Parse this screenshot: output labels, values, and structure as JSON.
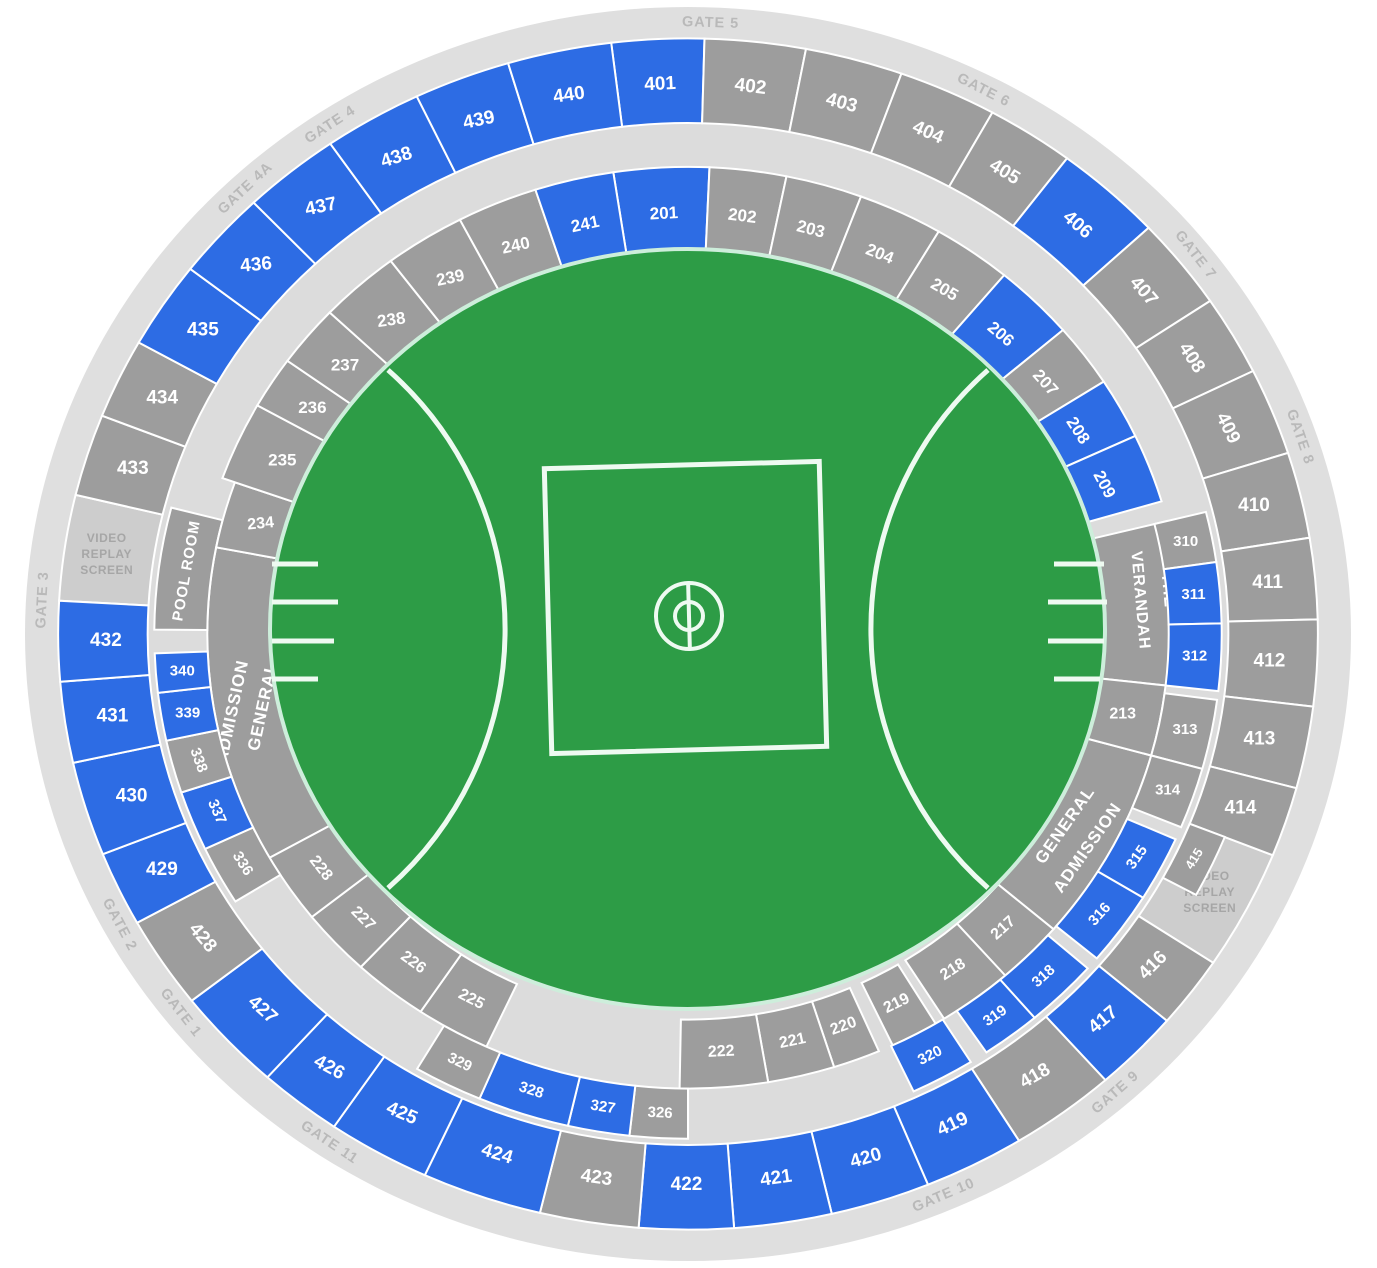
{
  "map": {
    "colors": {
      "available": "#2d6ce4",
      "standard": "#9d9d9d",
      "screen_fill": "#cdcdcd",
      "walkway": "#dcdcdc",
      "promenade": "#dfdfdf",
      "field": "#2d9c46",
      "field_edge": "#cdeedb",
      "field_line": "#eefaf1",
      "gate_text": "#b9b9b9",
      "screen_text": "#a6a6a6",
      "section_text": "#ffffff"
    },
    "gates": [
      {
        "label": "GATE 1",
        "a": 231.7,
        "rot": 52
      },
      {
        "label": "GATE 2",
        "a": 241.6,
        "rot": 62
      },
      {
        "label": "GATE 3",
        "a": 273.2,
        "rot": -87
      },
      {
        "label": "GATE 4A",
        "a": 316.8,
        "rot": -43
      },
      {
        "label": "GATE 4",
        "a": 326.4,
        "rot": -33
      },
      {
        "label": "GATE 5",
        "a": 2.0,
        "rot": 2
      },
      {
        "label": "GATE 6",
        "a": 27.2,
        "rot": 27
      },
      {
        "label": "GATE 7",
        "a": 51.7,
        "rot": 52
      },
      {
        "label": "GATE 8",
        "a": 71.2,
        "rot": 71
      },
      {
        "label": "GATE 9",
        "a": 138.6,
        "rot": -41
      },
      {
        "label": "GATE 10",
        "a": 156.7,
        "rot": -23
      },
      {
        "label": "GATE 11",
        "a": 213.7,
        "rot": 34
      }
    ],
    "outer_sections": [
      {
        "n": "401",
        "a0": 353.0,
        "a1": 361.5,
        "c": "b",
        "rot": -3
      },
      {
        "n": "402",
        "a0": 1.5,
        "a1": 10.8,
        "c": "g",
        "rot": 7
      },
      {
        "n": "403",
        "a0": 10.8,
        "a1": 19.8,
        "c": "g",
        "rot": 15
      },
      {
        "n": "404",
        "a0": 19.8,
        "a1": 28.9,
        "c": "g",
        "rot": 24
      },
      {
        "n": "405",
        "a0": 28.9,
        "a1": 37.0,
        "c": "g",
        "rot": 31
      },
      {
        "n": "406",
        "a0": 37.0,
        "a1": 47.0,
        "c": "b",
        "rot": 41
      },
      {
        "n": "407",
        "a0": 47.0,
        "a1": 56.0,
        "c": "g",
        "rot": 49
      },
      {
        "n": "408",
        "a0": 56.0,
        "a1": 63.8,
        "c": "g",
        "rot": 57
      },
      {
        "n": "409",
        "a0": 63.8,
        "a1": 72.3,
        "c": "g",
        "rot": 64
      },
      {
        "n": "410",
        "a0": 72.3,
        "a1": 80.7,
        "c": "g",
        "rot": 0
      },
      {
        "n": "411",
        "a0": 80.7,
        "a1": 88.6,
        "c": "g",
        "rot": 0
      },
      {
        "n": "412",
        "a0": 88.6,
        "a1": 97.0,
        "c": "g",
        "rot": 0
      },
      {
        "n": "413",
        "a0": 97.0,
        "a1": 105.0,
        "c": "g",
        "rot": 0
      },
      {
        "n": "414",
        "a0": 105.0,
        "a1": 111.8,
        "c": "g",
        "rot": 0
      },
      {
        "n": "415",
        "a0": 111.8,
        "a1": 118.5,
        "c": "g",
        "rot": -58,
        "r0": 0.815,
        "r1": 0.872,
        "lr": 0.843,
        "fs": 13
      },
      {
        "n": "416",
        "a0": 123.5,
        "a1": 130.5,
        "c": "g",
        "rot": -45
      },
      {
        "n": "417",
        "a0": 130.5,
        "a1": 138.5,
        "c": "b",
        "rot": -40
      },
      {
        "n": "418",
        "a0": 138.5,
        "a1": 148.3,
        "c": "g",
        "rot": -30
      },
      {
        "n": "419",
        "a0": 148.3,
        "a1": 157.6,
        "c": "b",
        "rot": -25
      },
      {
        "n": "420",
        "a0": 157.6,
        "a1": 166.8,
        "c": "b",
        "rot": -16
      },
      {
        "n": "421",
        "a0": 166.8,
        "a1": 175.8,
        "c": "b",
        "rot": -8
      },
      {
        "n": "422",
        "a0": 175.8,
        "a1": 184.5,
        "c": "b",
        "rot": 0
      },
      {
        "n": "423",
        "a0": 184.5,
        "a1": 193.6,
        "c": "g",
        "rot": 8
      },
      {
        "n": "424",
        "a0": 193.6,
        "a1": 204.7,
        "c": "b",
        "rot": 17
      },
      {
        "n": "425",
        "a0": 204.7,
        "a1": 214.2,
        "c": "b",
        "rot": 23
      },
      {
        "n": "426",
        "a0": 214.2,
        "a1": 221.9,
        "c": "b",
        "rot": 28
      },
      {
        "n": "427",
        "a0": 221.9,
        "a1": 232.0,
        "c": "b",
        "rot": 42
      },
      {
        "n": "428",
        "a0": 232.0,
        "a1": 241.0,
        "c": "g",
        "rot": 50
      },
      {
        "n": "429",
        "a0": 241.0,
        "a1": 248.3,
        "c": "b",
        "rot": 0
      },
      {
        "n": "430",
        "a0": 248.3,
        "a1": 257.5,
        "c": "b",
        "rot": 0
      },
      {
        "n": "431",
        "a0": 257.5,
        "a1": 265.4,
        "c": "b",
        "rot": 0
      },
      {
        "n": "432",
        "a0": 265.4,
        "a1": 273.2,
        "c": "b",
        "rot": 0
      },
      {
        "n": "433",
        "a0": 283.5,
        "a1": 291.5,
        "c": "g",
        "rot": 0
      },
      {
        "n": "434",
        "a0": 291.5,
        "a1": 299.3,
        "c": "g",
        "rot": 0
      },
      {
        "n": "435",
        "a0": 299.3,
        "a1": 307.8,
        "c": "b",
        "rot": 0
      },
      {
        "n": "436",
        "a0": 307.8,
        "a1": 316.4,
        "c": "b",
        "rot": -5
      },
      {
        "n": "437",
        "a0": 316.4,
        "a1": 325.4,
        "c": "b",
        "rot": -12
      },
      {
        "n": "438",
        "a0": 325.4,
        "a1": 334.5,
        "c": "b",
        "rot": -18
      },
      {
        "n": "439",
        "a0": 334.5,
        "a1": 343.4,
        "c": "b",
        "rot": -12
      },
      {
        "n": "440",
        "a0": 343.4,
        "a1": 353.0,
        "c": "b",
        "rot": -8
      }
    ],
    "inner_sections": [
      {
        "n": "201",
        "a0": 351.3,
        "a1": 362.5,
        "c": "b",
        "rot": -3,
        "band": "full"
      },
      {
        "n": "202",
        "a0": 2.5,
        "a1": 11.5,
        "c": "g",
        "rot": 7,
        "band": "full"
      },
      {
        "n": "203",
        "a0": 11.5,
        "a1": 20.5,
        "c": "g",
        "rot": 14,
        "band": "full"
      },
      {
        "n": "204",
        "a0": 20.5,
        "a1": 30.5,
        "c": "g",
        "rot": 22,
        "band": "full"
      },
      {
        "n": "205",
        "a0": 30.5,
        "a1": 39.8,
        "c": "g",
        "rot": 30,
        "band": "full"
      },
      {
        "n": "206",
        "a0": 39.8,
        "a1": 49.4,
        "c": "b",
        "rot": 40,
        "band": "full"
      },
      {
        "n": "207",
        "a0": 49.4,
        "a1": 57.3,
        "c": "g",
        "rot": 48,
        "band": "full"
      },
      {
        "n": "208",
        "a0": 57.3,
        "a1": 64.9,
        "c": "b",
        "rot": 57,
        "band": "full"
      },
      {
        "n": "209",
        "a0": 64.9,
        "a1": 73.5,
        "c": "b",
        "rot": 62,
        "band": "full"
      },
      {
        "n": "213",
        "a0": 96.5,
        "a1": 105.5,
        "c": "g",
        "rot": 0,
        "band": "lower"
      },
      {
        "n": "217",
        "a0": 130.5,
        "a1": 138.7,
        "c": "g",
        "rot": -42,
        "band": "lower"
      },
      {
        "n": "218",
        "a0": 138.7,
        "a1": 147.8,
        "c": "g",
        "rot": -33,
        "band": "lower"
      },
      {
        "n": "219",
        "a0": 149.0,
        "a1": 154.8,
        "c": "g",
        "rot": -26,
        "band": "lower"
      },
      {
        "n": "220",
        "a0": 156.6,
        "a1": 162.3,
        "c": "g",
        "rot": -20,
        "band": "lower"
      },
      {
        "n": "221",
        "a0": 162.3,
        "a1": 170.4,
        "c": "g",
        "rot": -12,
        "band": "lower"
      },
      {
        "n": "222",
        "a0": 170.4,
        "a1": 181.0,
        "c": "g",
        "rot": -3,
        "band": "lower"
      },
      {
        "n": "225",
        "a0": 204.8,
        "a1": 213.8,
        "c": "g",
        "rot": 27,
        "band": "lower"
      },
      {
        "n": "226",
        "a0": 213.8,
        "a1": 222.9,
        "c": "g",
        "rot": 36,
        "band": "lower"
      },
      {
        "n": "227",
        "a0": 222.9,
        "a1": 231.5,
        "c": "g",
        "rot": 45,
        "band": "lower"
      },
      {
        "n": "228",
        "a0": 231.5,
        "a1": 240.5,
        "c": "g",
        "rot": 52,
        "band": "lower"
      },
      {
        "n": "234",
        "a0": 281.0,
        "a1": 289.5,
        "c": "g",
        "rot": -5,
        "band": "lower"
      },
      {
        "n": "235",
        "a0": 289.5,
        "a1": 299.3,
        "c": "g",
        "rot": 0,
        "band": "full"
      },
      {
        "n": "236",
        "a0": 299.3,
        "a1": 305.8,
        "c": "g",
        "rot": 0,
        "band": "full"
      },
      {
        "n": "237",
        "a0": 305.8,
        "a1": 313.5,
        "c": "g",
        "rot": 0,
        "band": "full"
      },
      {
        "n": "238",
        "a0": 313.5,
        "a1": 323.0,
        "c": "g",
        "rot": -8,
        "band": "full"
      },
      {
        "n": "239",
        "a0": 323.0,
        "a1": 332.5,
        "c": "g",
        "rot": -12,
        "band": "full"
      },
      {
        "n": "240",
        "a0": 332.5,
        "a1": 342.0,
        "c": "g",
        "rot": -12,
        "band": "full"
      },
      {
        "n": "241",
        "a0": 342.0,
        "a1": 351.3,
        "c": "b",
        "rot": -12,
        "band": "full"
      }
    ],
    "mid_sections": [
      {
        "n": "310",
        "a0": 76.0,
        "a1": 81.8,
        "c": "g",
        "rot": 0
      },
      {
        "n": "311",
        "a0": 81.8,
        "a1": 88.8,
        "c": "b",
        "rot": 0
      },
      {
        "n": "312",
        "a0": 88.8,
        "a1": 96.5,
        "c": "b",
        "rot": 0
      },
      {
        "n": "313",
        "a0": 97.5,
        "a1": 105.5,
        "c": "g",
        "rot": 0
      },
      {
        "n": "314",
        "a0": 105.5,
        "a1": 112.5,
        "c": "g",
        "rot": 0
      },
      {
        "n": "315",
        "a0": 114.0,
        "a1": 121.5,
        "c": "b",
        "rot": -55
      },
      {
        "n": "316",
        "a0": 121.5,
        "a1": 130.0,
        "c": "b",
        "rot": -48
      },
      {
        "n": "318",
        "a0": 131.5,
        "a1": 139.5,
        "c": "b",
        "rot": -42
      },
      {
        "n": "319",
        "a0": 139.5,
        "a1": 146.0,
        "c": "b",
        "rot": -35
      },
      {
        "n": "320",
        "a0": 148.0,
        "a1": 155.0,
        "c": "b",
        "rot": -27
      },
      {
        "n": "326",
        "a0": 180.0,
        "a1": 186.3,
        "c": "g",
        "rot": 3
      },
      {
        "n": "327",
        "a0": 186.3,
        "a1": 193.0,
        "c": "b",
        "rot": 9
      },
      {
        "n": "328",
        "a0": 193.0,
        "a1": 203.0,
        "c": "b",
        "rot": 18
      },
      {
        "n": "329",
        "a0": 203.0,
        "a1": 210.5,
        "c": "g",
        "rot": 26
      },
      {
        "n": "336",
        "a0": 238.0,
        "a1": 244.8,
        "c": "g",
        "rot": 58
      },
      {
        "n": "337",
        "a0": 244.8,
        "a1": 251.7,
        "c": "b",
        "rot": 66
      },
      {
        "n": "338",
        "a0": 251.7,
        "a1": 257.8,
        "c": "g",
        "rot": 70
      },
      {
        "n": "339",
        "a0": 257.8,
        "a1": 263.3,
        "c": "b",
        "rot": 0
      },
      {
        "n": "340",
        "a0": 263.3,
        "a1": 267.8,
        "c": "b",
        "rot": 0
      }
    ],
    "zones": [
      {
        "name": "general-admission-left",
        "a0": 240.5,
        "a1": 281.0,
        "band": "lower",
        "lines": [
          {
            "t": "GENERAL",
            "a": 259.8,
            "r": 0.652,
            "rot": -78,
            "fs": 17
          },
          {
            "t": "ADMISSION",
            "a": 259.8,
            "r": 0.699,
            "rot": -78,
            "fs": 17
          }
        ]
      },
      {
        "name": "pool-room",
        "a0": 270.5,
        "a1": 284.5,
        "band": "mid",
        "lines": [
          {
            "t": "POOL ROOM",
            "a": 277.6,
            "r": 0.763,
            "rot": -80,
            "fs": 15
          }
        ]
      },
      {
        "name": "the-verandah",
        "a0": 76.0,
        "a1": 96.5,
        "band": "full",
        "lines": [
          {
            "t": "THE",
            "a": 84.5,
            "r": 0.727,
            "rot": 85,
            "fs": 16
          },
          {
            "t": "VERANDAH",
            "a": 85.5,
            "r": 0.684,
            "rot": 85,
            "fs": 16
          }
        ]
      },
      {
        "name": "general-admission-right",
        "a0": 105.5,
        "a1": 130.5,
        "band": "lower",
        "lines": [
          {
            "t": "GENERAL",
            "a": 118.2,
            "r": 0.645,
            "rot": -55,
            "fs": 17
          },
          {
            "t": "ADMISSION",
            "a": 119.5,
            "r": 0.692,
            "rot": -55,
            "fs": 17
          }
        ]
      }
    ],
    "screens": [
      {
        "name": "video-replay-screen-right",
        "a0": 111.8,
        "a1": 123.5,
        "la": 117.6,
        "lr": 0.888,
        "lines": [
          "VIDEO",
          "REPLAY",
          "SCREEN"
        ]
      },
      {
        "name": "video-replay-screen-left",
        "a0": 273.2,
        "a1": 283.5,
        "la": 278.3,
        "lr": 0.886,
        "lines": [
          "VIDEO",
          "REPLAY",
          "SCREEN"
        ]
      }
    ],
    "field": {
      "ellipse": {
        "cx": 687.5,
        "cy": 629,
        "rx": 417.5,
        "ry": 380
      },
      "square": {
        "x": 548,
        "y": 465,
        "w": 275,
        "h": 285,
        "rot": -1.5
      },
      "circle": {
        "cx": 689,
        "cy": 616,
        "r_outer": 33,
        "r_inner": 14,
        "line_y1": 583,
        "line_y2": 649
      },
      "arcs": [
        "M388,370 A345,345 0 0 1 388,888",
        "M988,370 A345,345 0 0 0 988,888"
      ],
      "bench_lines_left": [
        [
          272,
          564,
          318
        ],
        [
          272,
          602,
          338
        ],
        [
          272,
          641,
          334
        ],
        [
          272,
          679,
          318
        ]
      ],
      "bench_lines_right": [
        [
          1054,
          564,
          1104
        ],
        [
          1048,
          602,
          1107
        ],
        [
          1048,
          641,
          1104
        ],
        [
          1054,
          679,
          1100
        ]
      ]
    }
  }
}
